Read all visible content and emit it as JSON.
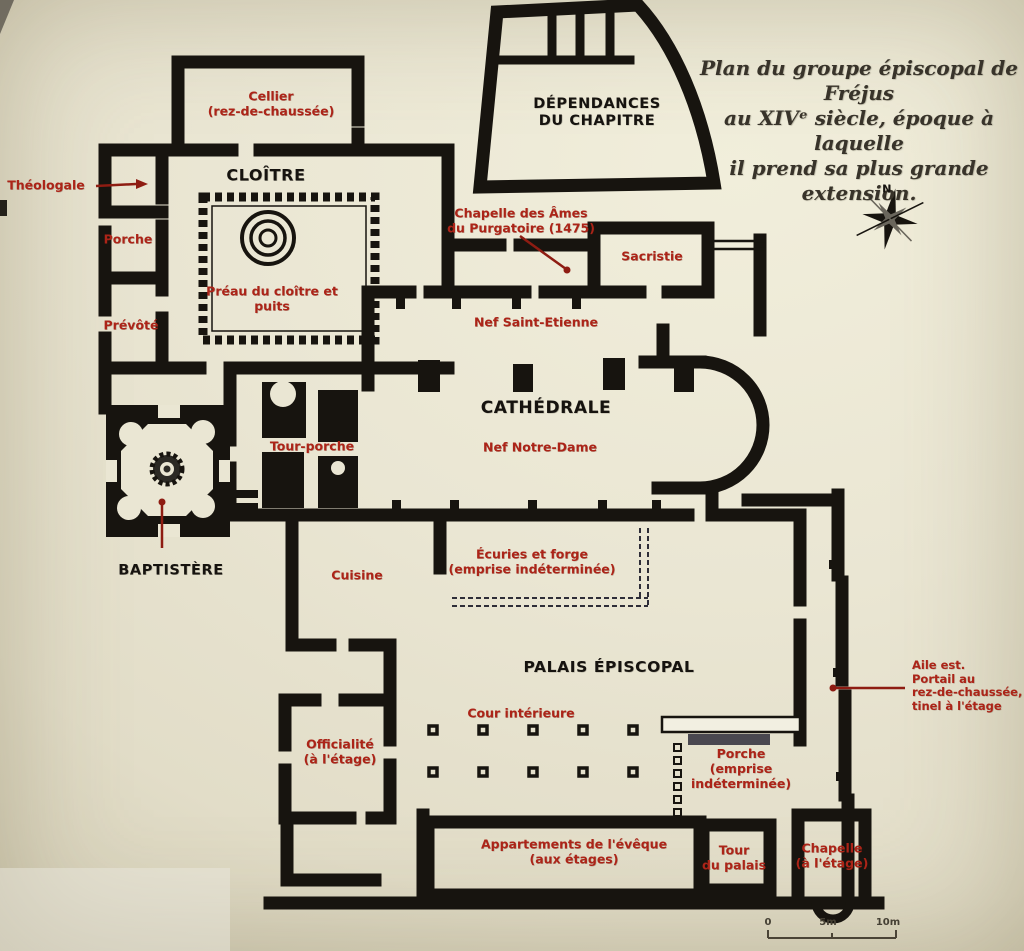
{
  "colors": {
    "paper": "#eae6d3",
    "wall_black": "#17140f",
    "label_red": "#ac2418",
    "leader_red": "#8e1c12",
    "caption_ink": "#38332a"
  },
  "caption": {
    "text": "Plan du groupe épiscopal de Fréjus\nau XIVᵉ siècle, époque à laquelle\nil prend sa plus grande extension."
  },
  "compass": {
    "north": "N"
  },
  "scale_bar": {
    "start": "0",
    "mid": "5m",
    "end": "10m"
  },
  "labels": {
    "cellier": "Cellier\n(rez-de-chaussée)",
    "cloitre": "CLOÎTRE",
    "theologale": "Théologale",
    "porche_cloitre": "Porche",
    "prevote": "Prévôté",
    "preau": "Préau du cloître et\npuits",
    "dependances": "DÉPENDANCES\nDU CHAPITRE",
    "chapelle_ames": "Chapelle des Âmes\ndu Purgatoire (1475)",
    "sacristie": "Sacristie",
    "nef_saint_etienne": "Nef Saint-Etienne",
    "cathedrale": "CATHÉDRALE",
    "nef_notre_dame": "Nef Notre-Dame",
    "tour_porche": "Tour-porche",
    "baptistere": "BAPTISTÈRE",
    "cuisine": "Cuisine",
    "ecuries": "Écuries et forge\n(emprise indéterminée)",
    "palais": "PALAIS ÉPISCOPAL",
    "cour": "Cour intérieure",
    "officialite": "Officialité\n(à l'étage)",
    "porche_palais": "Porche\n(emprise\nindéterminée)",
    "appartements": "Appartements de l'évêque\n(aux étages)",
    "tour_palais": "Tour\ndu palais",
    "chapelle_palais": "Chapelle\n(à l'étage)",
    "aile_est": "Aile est.\nPortail au\nrez-de-chaussée,\ntinel à l'étage"
  }
}
